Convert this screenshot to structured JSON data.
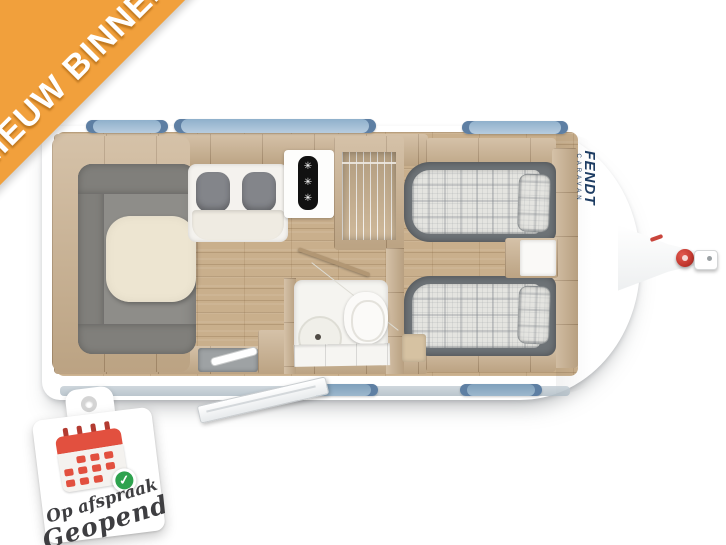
{
  "ribbon": {
    "label": "NIEUW BINNEN"
  },
  "caravan": {
    "brand": "FENDT",
    "brand_sub": "CARAVAN",
    "rooms": [
      "lounge",
      "dinette-bench",
      "kitchen",
      "wardrobe",
      "bathroom",
      "twin-beds"
    ]
  },
  "badge": {
    "line1": "Op afspraak",
    "line2": "Geopend"
  },
  "icons": {
    "burner-icon": "✳",
    "check-icon": "✓"
  },
  "colors": {
    "ribbon_orange": "#F1A03C",
    "window_blue": "#9FBCD4",
    "window_blue_dark": "#5E7FA3",
    "wood": "#C7AD8B",
    "wood_dark": "#B29774",
    "wood_light": "#D6C2A2",
    "floor": "#C9AF8C",
    "sofa_gray": "#8E8D89",
    "sofa_gray_dark": "#807F7B",
    "table_cream": "#EDE5D1",
    "bed_frame": "#6E7377",
    "plaid_base": "#E4E4E0",
    "brand_navy": "#1E3D63",
    "hitch_red": "#C2372E",
    "badge_red": "#E2503F",
    "badge_green": "#2EA24E",
    "badge_text": "#3E3E41"
  }
}
